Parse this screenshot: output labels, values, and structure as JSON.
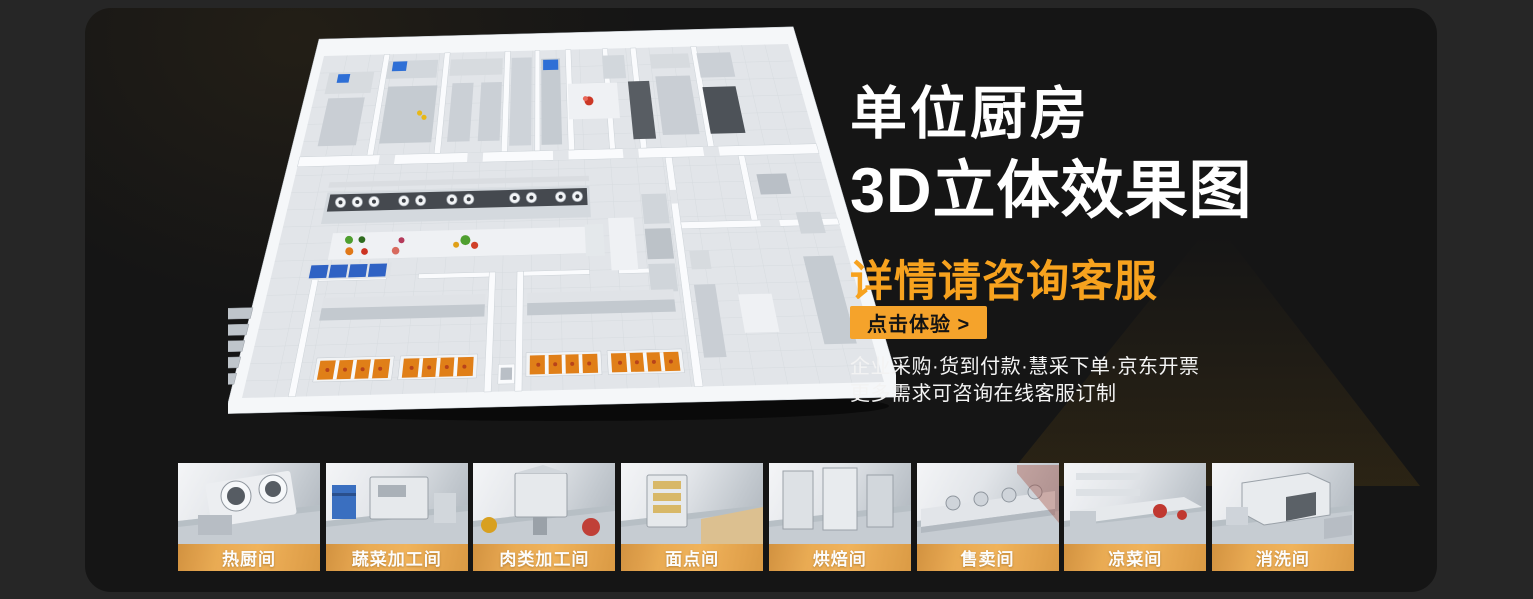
{
  "hero": {
    "title_line1": "单位厨房",
    "title_line2": "3D立体效果图",
    "subtitle": "详情请咨询客服",
    "cta_label": "点击体验 >",
    "info_line1": "企业采购·货到付款·慧采下单·京东开票",
    "info_line2": "更多需求可咨询在线客服订制"
  },
  "colors": {
    "accent_orange": "#F5A32B",
    "subtitle_orange": "#F7A21E",
    "cta_text": "#141414",
    "card_bg": "#151515",
    "page_bg": "#262626",
    "label_bar_orange": "#EAA94E"
  },
  "floorplan": {
    "name": "unit-kitchen-3d-floorplan"
  },
  "rooms": [
    {
      "label": "热厨间"
    },
    {
      "label": "蔬菜加工间"
    },
    {
      "label": "肉类加工间"
    },
    {
      "label": "面点间"
    },
    {
      "label": "烘焙间"
    },
    {
      "label": "售卖间"
    },
    {
      "label": "凉菜间"
    },
    {
      "label": "消洗间"
    }
  ]
}
